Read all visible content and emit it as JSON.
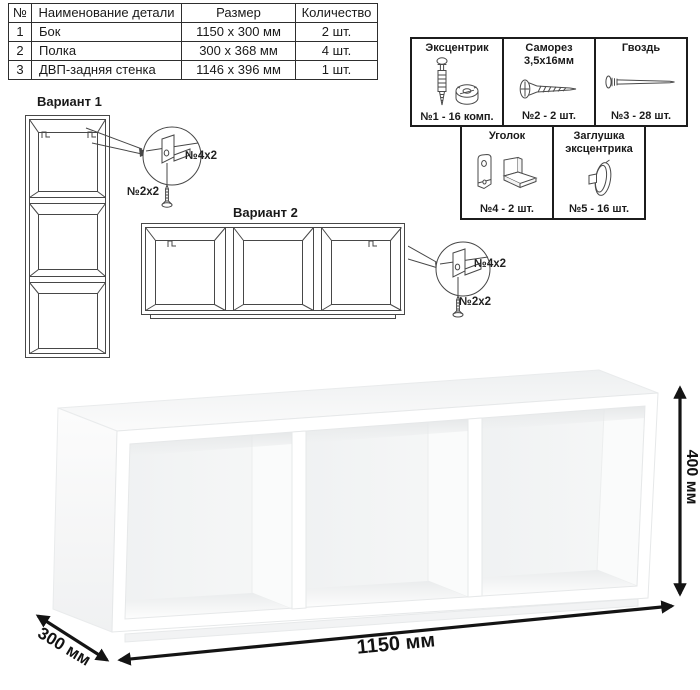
{
  "table": {
    "headers": [
      "№",
      "Наименование детали",
      "Размер",
      "Количество"
    ],
    "rows": [
      {
        "num": "1",
        "name": "Бок",
        "size": "1150 x 300 мм",
        "qty": "2 шт."
      },
      {
        "num": "2",
        "name": "Полка",
        "size": "300 x 368 мм",
        "qty": "4 шт."
      },
      {
        "num": "3",
        "name": "ДВП-задняя стенка",
        "size": "1146 x 396 мм",
        "qty": "1 шт."
      }
    ]
  },
  "hardware": {
    "items": [
      {
        "name": "Эксцентрик",
        "count": "№1 - 16 комп.",
        "icon": "cam-lock-fitting"
      },
      {
        "name": "Саморез 3,5х16мм",
        "count": "№2 - 2 шт.",
        "icon": "self-tapping-screw"
      },
      {
        "name": "Гвоздь",
        "count": "№3 - 28 шт.",
        "icon": "nail"
      },
      {
        "name": "Уголок",
        "count": "№4 - 2 шт.",
        "icon": "angle-bracket"
      },
      {
        "name": "Заглушка эксцентрика",
        "count": "№5 - 16 шт.",
        "icon": "cam-cover-cap"
      }
    ]
  },
  "variants": {
    "v1": {
      "title": "Вариант 1",
      "bracket_label": "№4х2",
      "screw_label": "№2х2"
    },
    "v2": {
      "title": "Вариант 2",
      "bracket_label": "№4х2",
      "screw_label": "№2х2"
    }
  },
  "dimensions": {
    "width": "1150 мм",
    "depth": "300 мм",
    "height": "400 мм"
  }
}
